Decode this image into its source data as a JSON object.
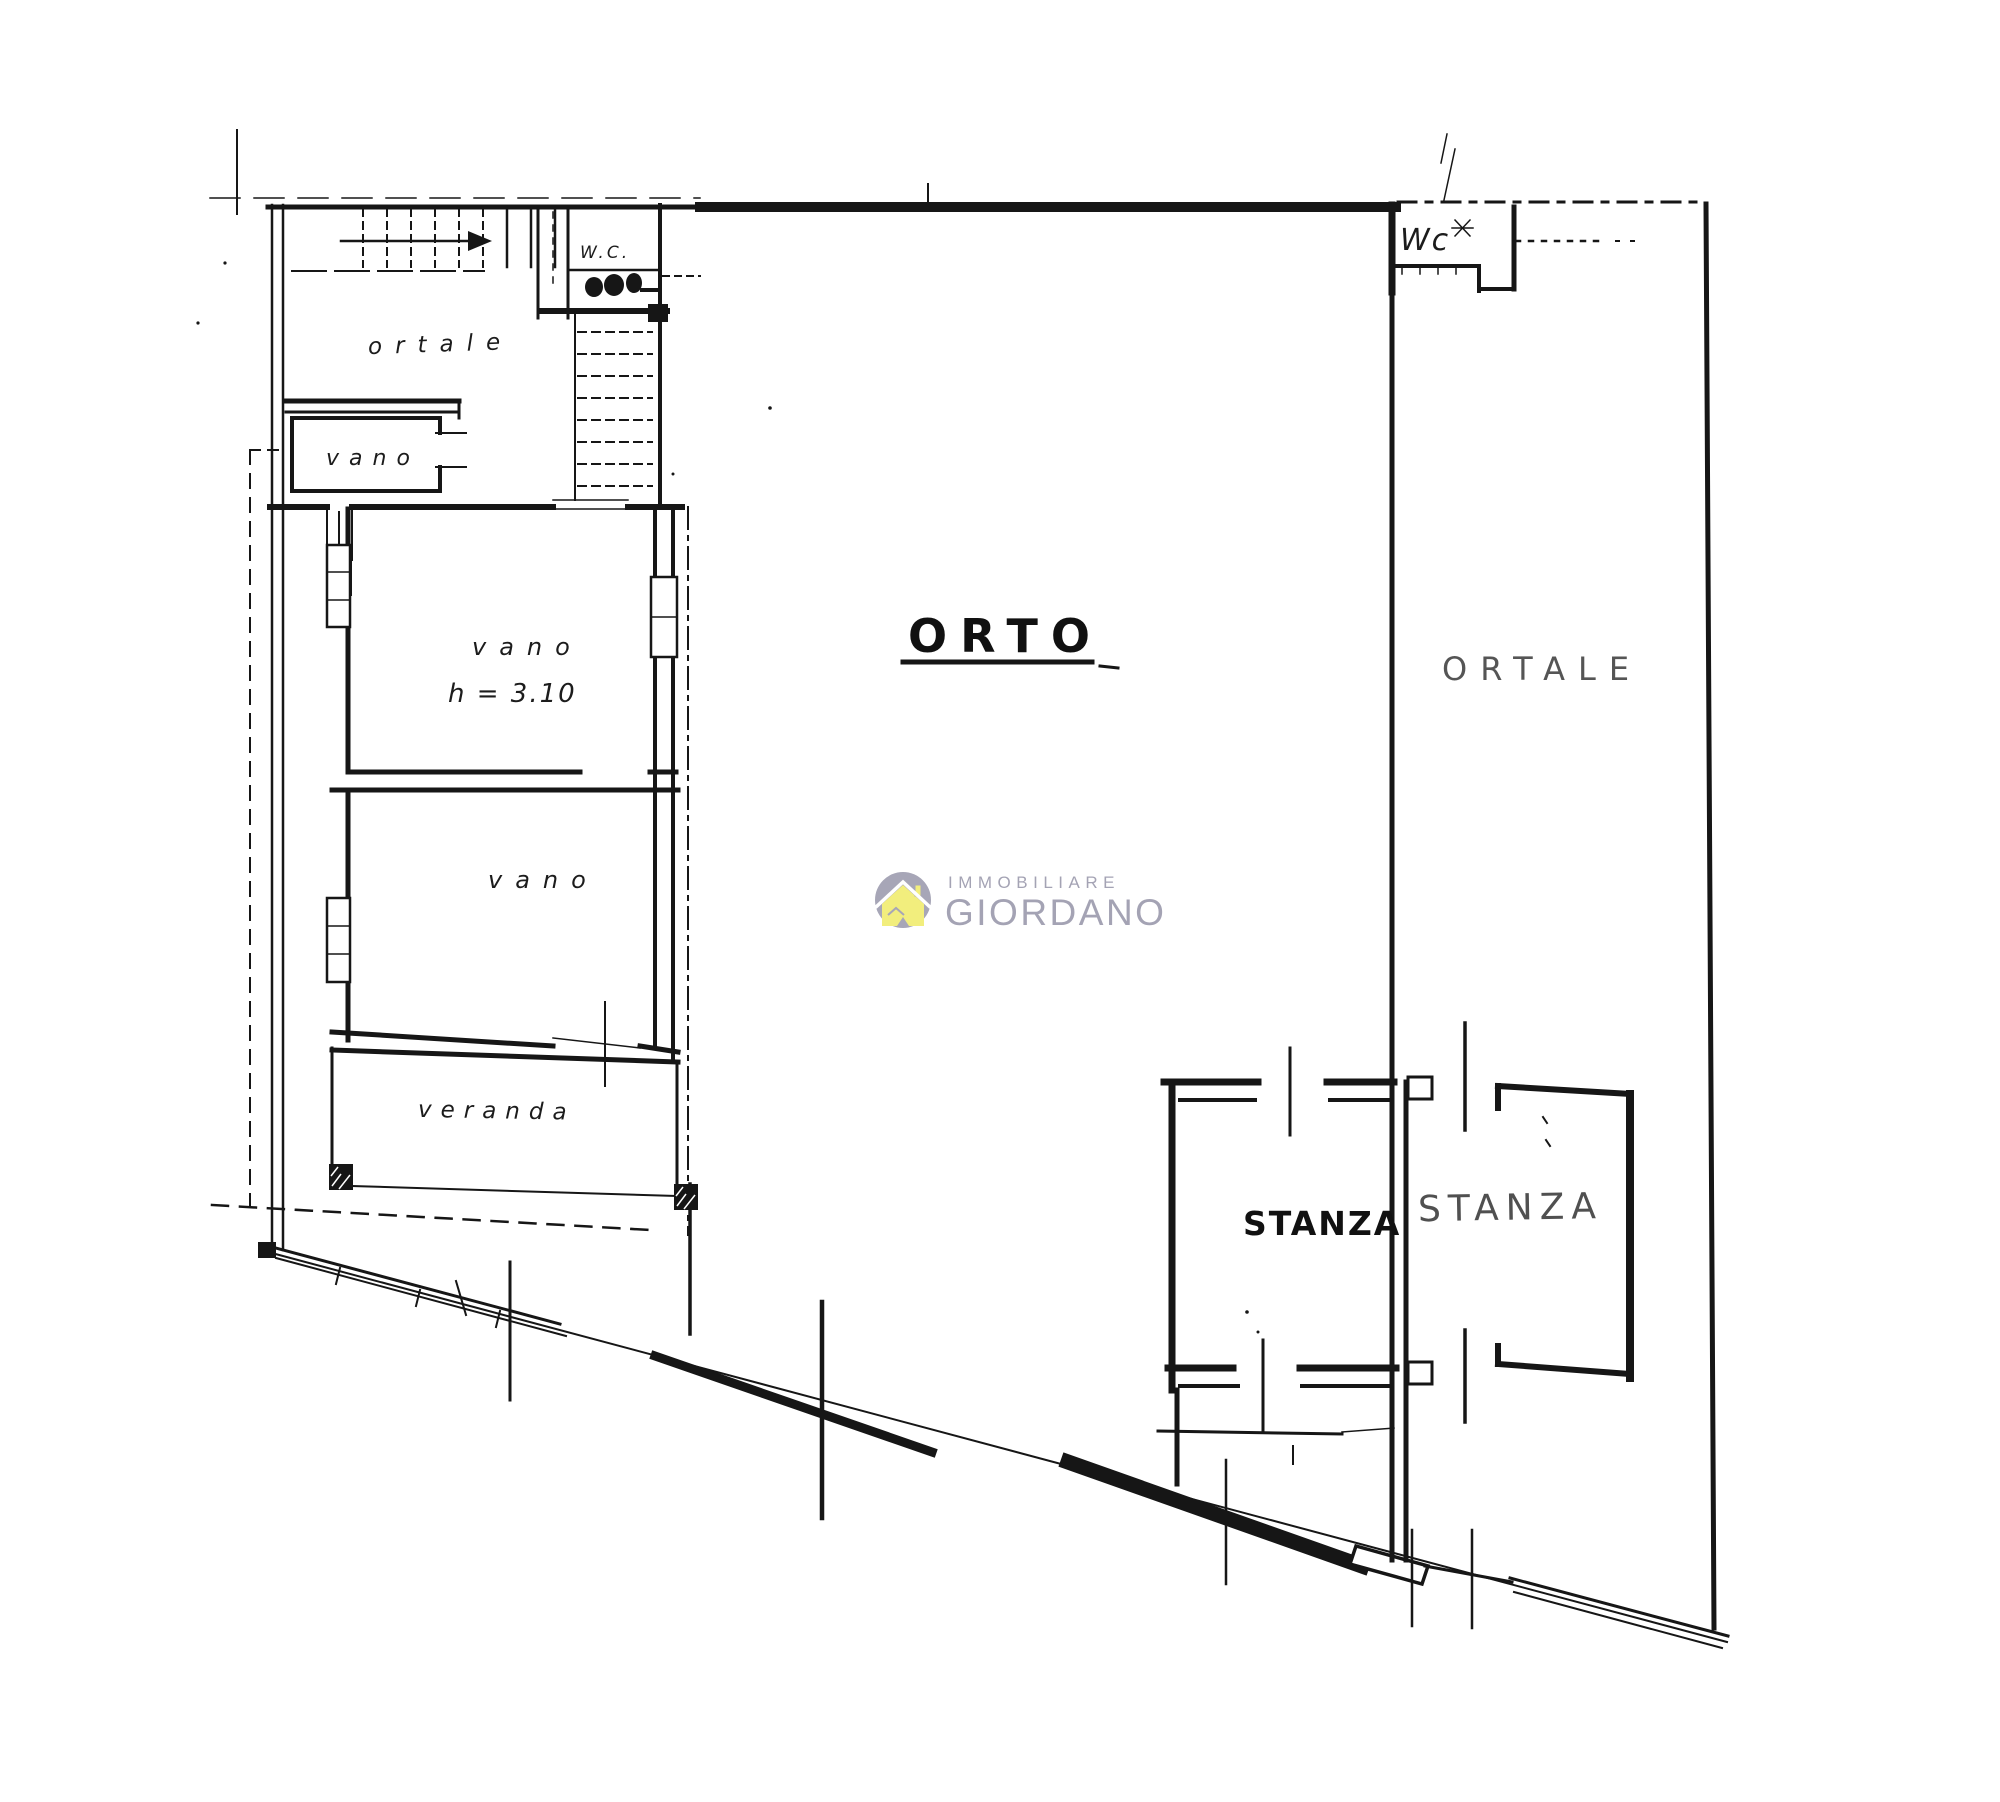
{
  "page": {
    "background": "#ffffff",
    "ink_color": "#161616"
  },
  "plan": {
    "rooms": {
      "ortale_top_left": {
        "label": "ortale"
      },
      "wc_top_left": {
        "label": "W.C."
      },
      "vano_small": {
        "label": "vano"
      },
      "vano_main": {
        "label": "vano",
        "height_note": "h = 3.10"
      },
      "vano_lower": {
        "label": "vano"
      },
      "veranda": {
        "label": "veranda"
      },
      "orto": {
        "label": "ORTO"
      },
      "ortale_right": {
        "label": "ORTALE"
      },
      "wc_top_right": {
        "label": "Wc"
      },
      "stanza_left": {
        "label": "STANZA"
      },
      "stanza_right": {
        "label": "STANZA"
      }
    },
    "watermark": {
      "line1": "IMMOBILIARE",
      "line2": "GIORDANO",
      "icon": "house-icon",
      "circle_color": "#a7a6b7",
      "house_color": "#f2ee7d",
      "text_color": "#a4a3b4"
    }
  }
}
